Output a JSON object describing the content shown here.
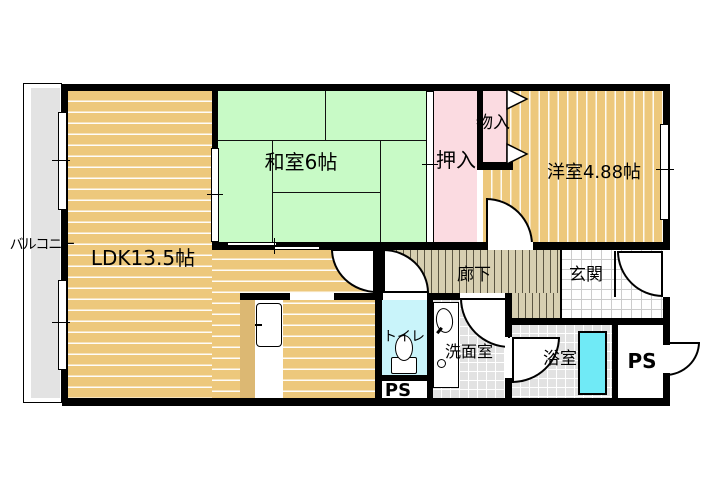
{
  "title": "apartment-floor-plan",
  "labels": {
    "balcony": "バルコニー",
    "ldk": "LDK13.5帖",
    "japanese_room": "和室6帖",
    "closet": "押入",
    "storage": "物入",
    "western_room": "洋室4.88帖",
    "hallway": "廊下",
    "entrance": "玄関",
    "toilet": "トイレ",
    "washroom": "洗面室",
    "bathroom": "浴室",
    "pipe_space_left": "PS",
    "pipe_space_right": "PS"
  },
  "colors": {
    "wood_floor": "#edc87c",
    "counter_wood": "#dcb873",
    "tatami_green": "#c8fac6",
    "closet_pink": "#fbdbe1",
    "hallway_floor": "#d7cfb1",
    "toilet_floor": "#c9f4fa",
    "bathtub_cyan": "#70eaf6",
    "tile_gray": "#e2e2e2",
    "balcony_gray": "#e3e3e3",
    "wall": "#000000"
  }
}
